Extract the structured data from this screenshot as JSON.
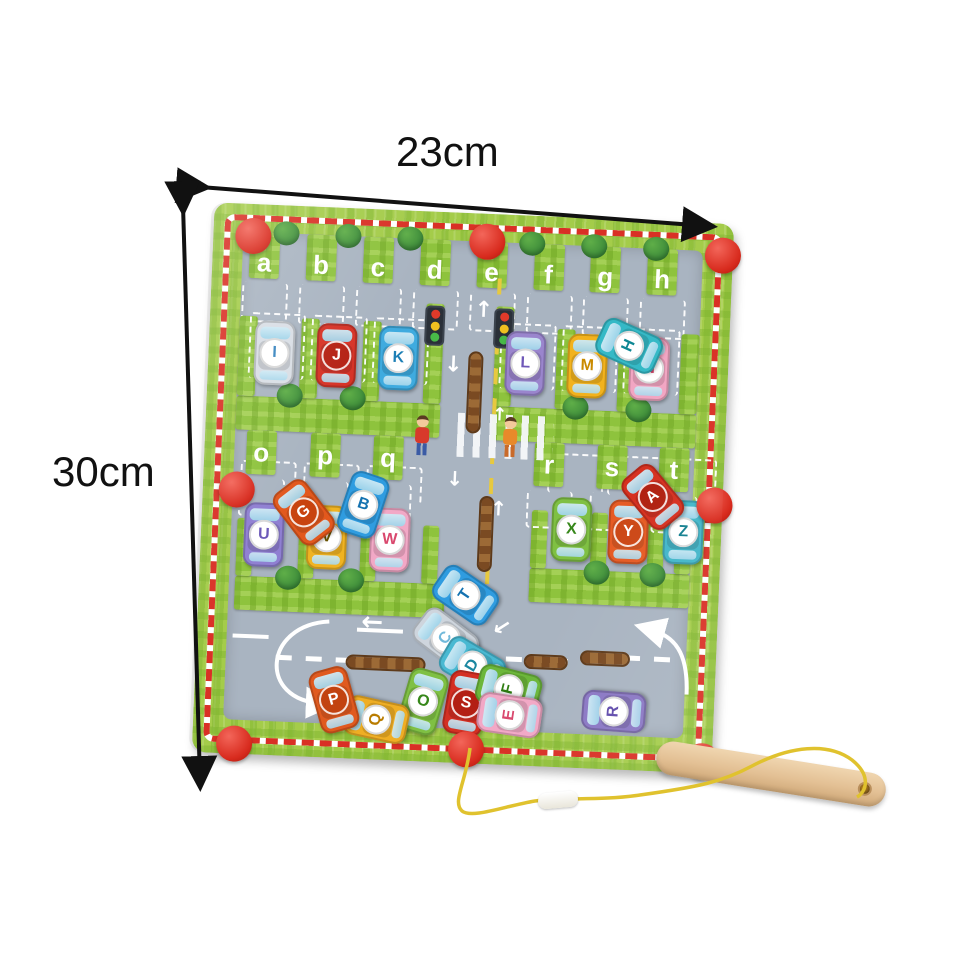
{
  "image": {
    "type": "product-photo",
    "subject": "magnetic alphabet maze board with letter cars and wooden magnetic wand",
    "background": "#ffffff"
  },
  "dimensions": {
    "width_label": "23cm",
    "height_label": "30cm"
  },
  "board": {
    "top_slots": [
      "a",
      "b",
      "c",
      "d",
      "e",
      "f",
      "g",
      "h"
    ],
    "mid_left_slots": [
      "o",
      "p",
      "q"
    ],
    "mid_right_slots": [
      "r",
      "s",
      "t"
    ],
    "colors": {
      "board_green": "#a4cc4a",
      "plaid_green": "#7db32e",
      "border_red": "#d93025",
      "road_gray": "#a9b4c1",
      "knob_red": "#d82b1e",
      "slot_dash_white": "#ffffff",
      "center_line_yellow": "#e7c93f",
      "track_brown": "#8a5a2b",
      "tree_green": "#3d8f3c",
      "string_yellow": "#e0c22e",
      "wand_wood": "#e3c094"
    }
  },
  "cars": [
    {
      "letter": "I",
      "body": "#d9dee5",
      "badge": "#ffffff",
      "text": "#3a86c0",
      "x": 46,
      "y": 116,
      "rot": 0
    },
    {
      "letter": "J",
      "body": "#d63226",
      "badge": "#b52114",
      "text": "#ffffff",
      "x": 108,
      "y": 116,
      "rot": 0
    },
    {
      "letter": "K",
      "body": "#3fabdf",
      "badge": "#ffffff",
      "text": "#1d7fb5",
      "x": 170,
      "y": 116,
      "rot": 0
    },
    {
      "letter": "L",
      "body": "#9a85cd",
      "badge": "#ffffff",
      "text": "#6f58b8",
      "x": 297,
      "y": 116,
      "rot": 0
    },
    {
      "letter": "M",
      "body": "#f2b21d",
      "badge": "#ffffff",
      "text": "#c98a00",
      "x": 359,
      "y": 116,
      "rot": 0
    },
    {
      "letter": "N",
      "body": "#f2a6c3",
      "badge": "#ffffff",
      "text": "#d9486e",
      "x": 421,
      "y": 116,
      "rot": 0
    },
    {
      "letter": "H",
      "body": "#35b9c6",
      "badge": "#ffffff",
      "text": "#0e8794",
      "x": 400,
      "y": 94,
      "rot": -68
    },
    {
      "letter": "U",
      "body": "#8f7fd2",
      "badge": "#ffffff",
      "text": "#6b58b8",
      "x": 43,
      "y": 298,
      "rot": 0
    },
    {
      "letter": "V",
      "body": "#f0b322",
      "badge": "#ffffff",
      "text": "#6b5500",
      "x": 106,
      "y": 298,
      "rot": 0
    },
    {
      "letter": "W",
      "body": "#f2a8c6",
      "badge": "#ffffff",
      "text": "#d9486e",
      "x": 169,
      "y": 298,
      "rot": 0
    },
    {
      "letter": "G",
      "body": "#e2581d",
      "badge": "#c8430f",
      "text": "#ffffff",
      "x": 82,
      "y": 274,
      "rot": -40
    },
    {
      "letter": "B",
      "body": "#2f9ce0",
      "badge": "#ffffff",
      "text": "#1472b0",
      "x": 141,
      "y": 264,
      "rot": 16
    },
    {
      "letter": "X",
      "body": "#7fc043",
      "badge": "#ffffff",
      "text": "#36871a",
      "x": 350,
      "y": 280,
      "rot": 0
    },
    {
      "letter": "Y",
      "body": "#e65b24",
      "badge": "#cc4716",
      "text": "#ffffff",
      "x": 407,
      "y": 280,
      "rot": 0
    },
    {
      "letter": "Z",
      "body": "#42b6c9",
      "badge": "#ffffff",
      "text": "#127f8f",
      "x": 462,
      "y": 278,
      "rot": 0
    },
    {
      "letter": "A",
      "body": "#d6301f",
      "badge": "#b02010",
      "text": "#ffffff",
      "x": 430,
      "y": 244,
      "rot": -42
    },
    {
      "letter": "T",
      "body": "#2f9ce0",
      "badge": "#ffffff",
      "text": "#1472b0",
      "x": 247,
      "y": 350,
      "rot": -58
    },
    {
      "letter": "C",
      "body": "#ced5dd",
      "badge": "#ffffff",
      "text": "#72b9da",
      "x": 229,
      "y": 394,
      "rot": -55
    },
    {
      "letter": "D",
      "body": "#49b9d2",
      "badge": "#ffffff",
      "text": "#1a87a0",
      "x": 257,
      "y": 420,
      "rot": -62
    },
    {
      "letter": "S",
      "body": "#d42f23",
      "badge": "#b31f14",
      "text": "#ffffff",
      "x": 252,
      "y": 458,
      "rot": 8
    },
    {
      "letter": "F",
      "body": "#6cb73a",
      "badge": "#ffffff",
      "text": "#2f7d12",
      "x": 294,
      "y": 442,
      "rot": -78
    },
    {
      "letter": "E",
      "body": "#f2a8c6",
      "badge": "#ffffff",
      "text": "#d9486e",
      "x": 296,
      "y": 468,
      "rot": -84
    },
    {
      "letter": "O",
      "body": "#7fc043",
      "badge": "#ffffff",
      "text": "#36871a",
      "x": 209,
      "y": 458,
      "rot": 14
    },
    {
      "letter": "Q",
      "body": "#efae24",
      "badge": "#ffffff",
      "text": "#b97c00",
      "x": 163,
      "y": 478,
      "rot": -80
    },
    {
      "letter": "P",
      "body": "#e05a1f",
      "badge": "#c24310",
      "text": "#ffffff",
      "x": 120,
      "y": 460,
      "rot": -18
    },
    {
      "letter": "R",
      "body": "#8a77c4",
      "badge": "#ffffff",
      "text": "#5f4aab",
      "x": 400,
      "y": 460,
      "rot": -88
    }
  ]
}
